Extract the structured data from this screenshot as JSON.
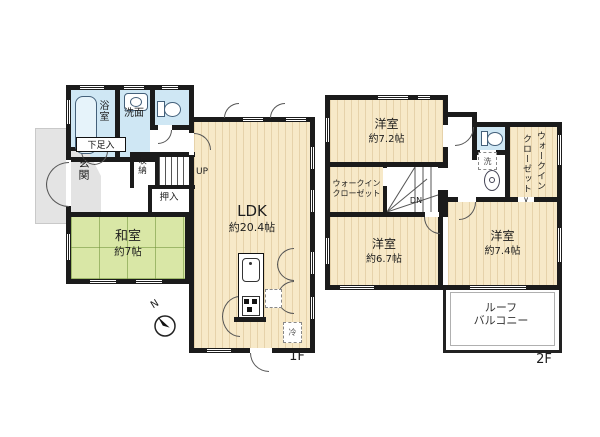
{
  "floor1": {
    "label": "1F",
    "bath": "浴室",
    "washroom": "洗面",
    "shoe_cabinet": "下足入",
    "entrance": "玄関",
    "storage": "収納",
    "stairs_up": "UP",
    "oshiire": "押入",
    "japanese_room": "和室",
    "japanese_room_size": "約7帖",
    "ldk": "LDK",
    "ldk_size": "約20.4帖",
    "fridge": "冷"
  },
  "floor2": {
    "label": "2F",
    "bedroom1": "洋室",
    "bedroom1_size": "約7.2帖",
    "wic_line1": "ウォークイン",
    "wic_line2": "クローゼット",
    "stairs_down": "DN",
    "washer": "洗",
    "wic_entry_mark": "∨",
    "bedroom2": "洋室",
    "bedroom2_size": "約6.7帖",
    "bedroom3": "洋室",
    "bedroom3_size": "約7.4帖",
    "balcony_line1": "ルーフ",
    "balcony_line2": "バルコニー"
  },
  "compass": {
    "north": "N"
  },
  "colors": {
    "wall": "#1b1b1b",
    "flooring": "#f7e9c8",
    "tatami": "#d9e7a6",
    "water": "#cfe7f4",
    "porch": "#e4e4e4"
  }
}
